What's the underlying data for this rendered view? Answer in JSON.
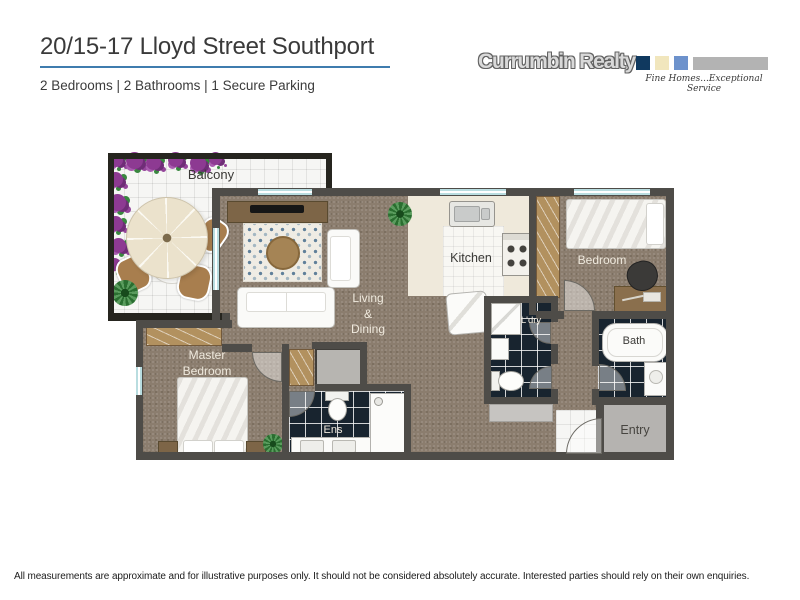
{
  "header": {
    "title": "20/15-17 Lloyd Street Southport",
    "subtitle": "2 Bedrooms | 2 Bathrooms | 1 Secure Parking",
    "accent_color": "#3f7cae"
  },
  "logo": {
    "name": "Currumbin Realty",
    "tagline": "Fine Homes...Exceptional Service",
    "square_colors": [
      "#10395f",
      "#f1e6bd",
      "#6d92cc"
    ],
    "bar_color": "#b3b3b3"
  },
  "floorplan": {
    "labels": {
      "balcony": "Balcony",
      "kitchen": "Kitchen",
      "living": [
        "Living",
        "&",
        "Dining"
      ],
      "bedroom": "Bedroom",
      "master": [
        "Master",
        "Bedroom"
      ],
      "laundry": "L'dry",
      "bath": "Bath",
      "ensuite": "Ens",
      "entry": "Entry"
    },
    "colors": {
      "wall": "#4e4c48",
      "carpet": "#8b7d6e",
      "dark_tile": "#18242f",
      "wardrobe": "#b2915f",
      "window_glass": "#b9dde0",
      "balcony_floor": "#f6f6f4",
      "kitchen_bench": "#efe9db",
      "entry_floor": "#b5b3b0"
    }
  },
  "disclaimer": "All measurements are approximate and for illustrative purposes only. It should not be considered absolutely accurate.  Interested parties should rely on their own enquiries."
}
